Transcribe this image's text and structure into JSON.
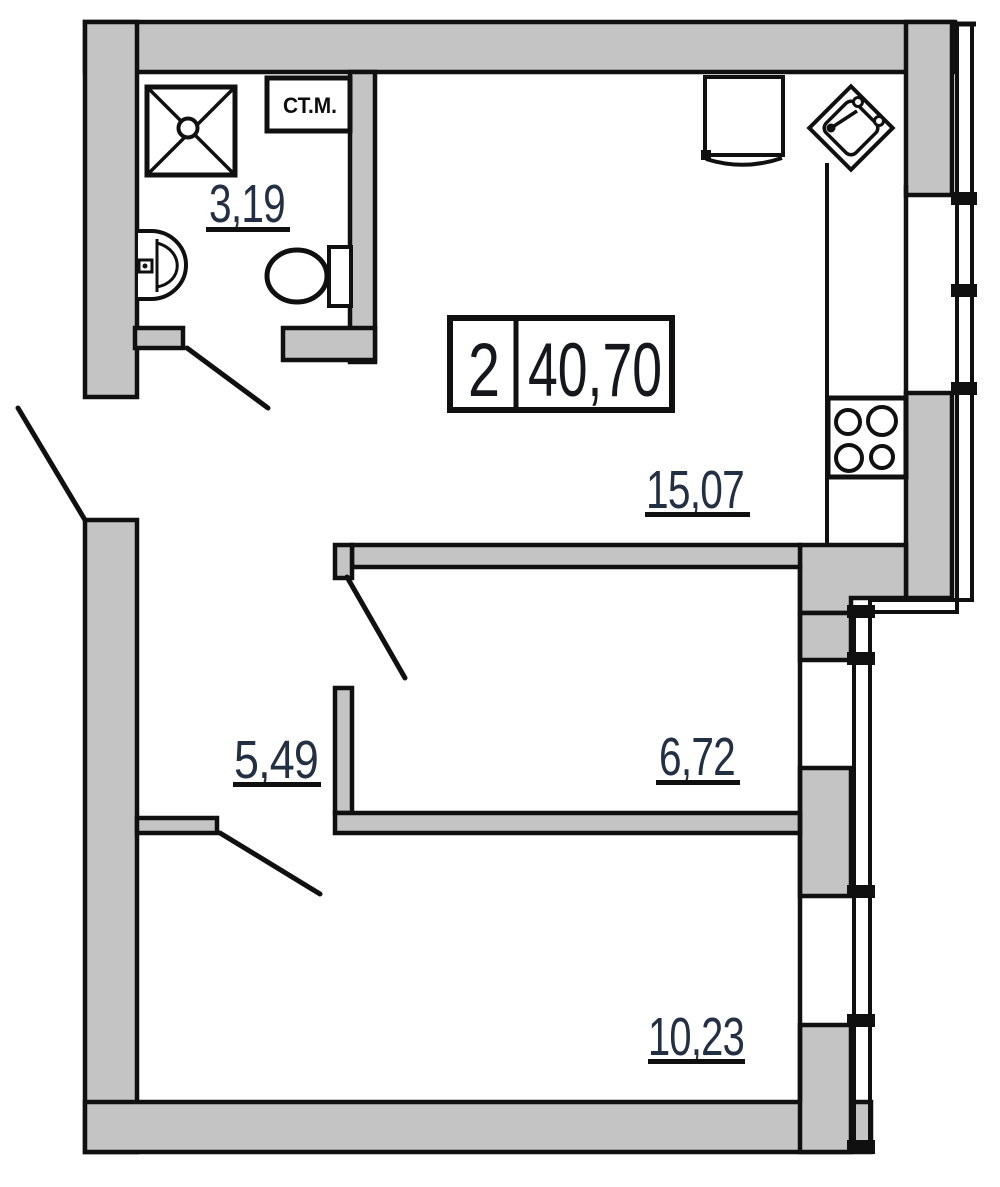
{
  "floor_plan": {
    "type": "apartment-floor-plan",
    "summary_box": {
      "room_count": "2",
      "total_area": "40,70"
    },
    "rooms": [
      {
        "name": "bathroom",
        "area": "3,19"
      },
      {
        "name": "kitchen-living-room",
        "area": "15,07"
      },
      {
        "name": "hallway",
        "area": "5,49"
      },
      {
        "name": "bedroom",
        "area": "6,72"
      },
      {
        "name": "living-room",
        "area": "10,23"
      }
    ],
    "appliance_labels": {
      "washing_machine": "СТ.М."
    },
    "fixtures": [
      "shower-tray",
      "wash-basin",
      "toilet",
      "kitchen-sink",
      "stove-4-burners",
      "kitchen-unit",
      "windows",
      "door-swings"
    ],
    "colors": {
      "wall_fill": "#c4c4c4",
      "line": "#101010",
      "room_label_text": "#232f42",
      "summary_text": "#15171c",
      "background": "#ffffff"
    }
  }
}
